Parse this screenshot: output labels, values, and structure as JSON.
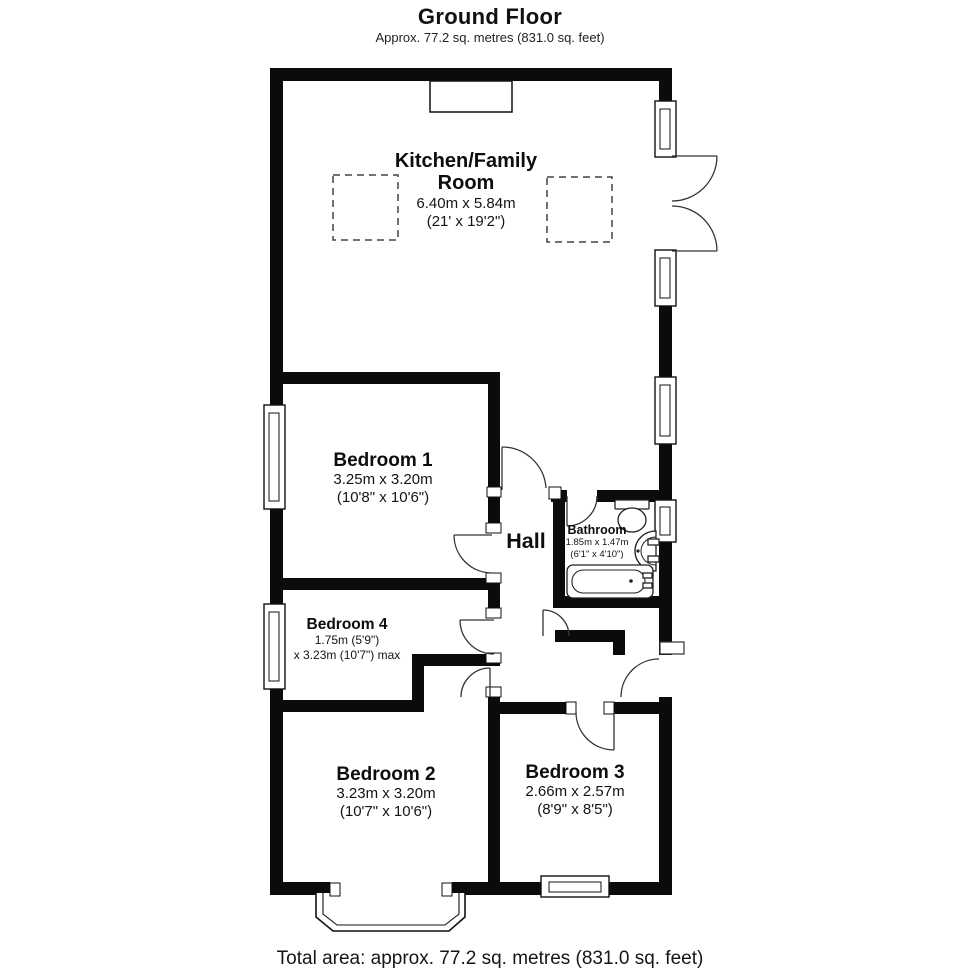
{
  "header": {
    "title": "Ground Floor",
    "subtitle": "Approx. 77.2 sq. metres (831.0 sq. feet)"
  },
  "footer": {
    "total_area": "Total area: approx. 77.2 sq. metres (831.0 sq. feet)"
  },
  "rooms": [
    {
      "id": "kitchen-family-room",
      "name": "Kitchen/Family Room",
      "metric": "6.40m x 5.84m",
      "imperial": "(21' x 19'2\")"
    },
    {
      "id": "bedroom-1",
      "name": "Bedroom 1",
      "metric": "3.25m x 3.20m",
      "imperial": "(10'8\" x 10'6\")"
    },
    {
      "id": "bedroom-4",
      "name": "Bedroom 4",
      "metric": "1.75m (5'9\")",
      "imperial": "x 3.23m (10'7\") max"
    },
    {
      "id": "hall",
      "name": "Hall"
    },
    {
      "id": "bathroom",
      "name": "Bathroom",
      "metric": "1.85m x 1.47m",
      "imperial": "(6'1\" x 4'10\")"
    },
    {
      "id": "bedroom-2",
      "name": "Bedroom 2",
      "metric": "3.23m x 3.20m",
      "imperial": "(10'7\" x 10'6\")"
    },
    {
      "id": "bedroom-3",
      "name": "Bedroom 3",
      "metric": "2.66m x 2.57m",
      "imperial": "(8'9\" x 8'5\")"
    }
  ],
  "colors": {
    "wall": "#0b0b0b",
    "line": "#333333",
    "background": "#ffffff"
  }
}
